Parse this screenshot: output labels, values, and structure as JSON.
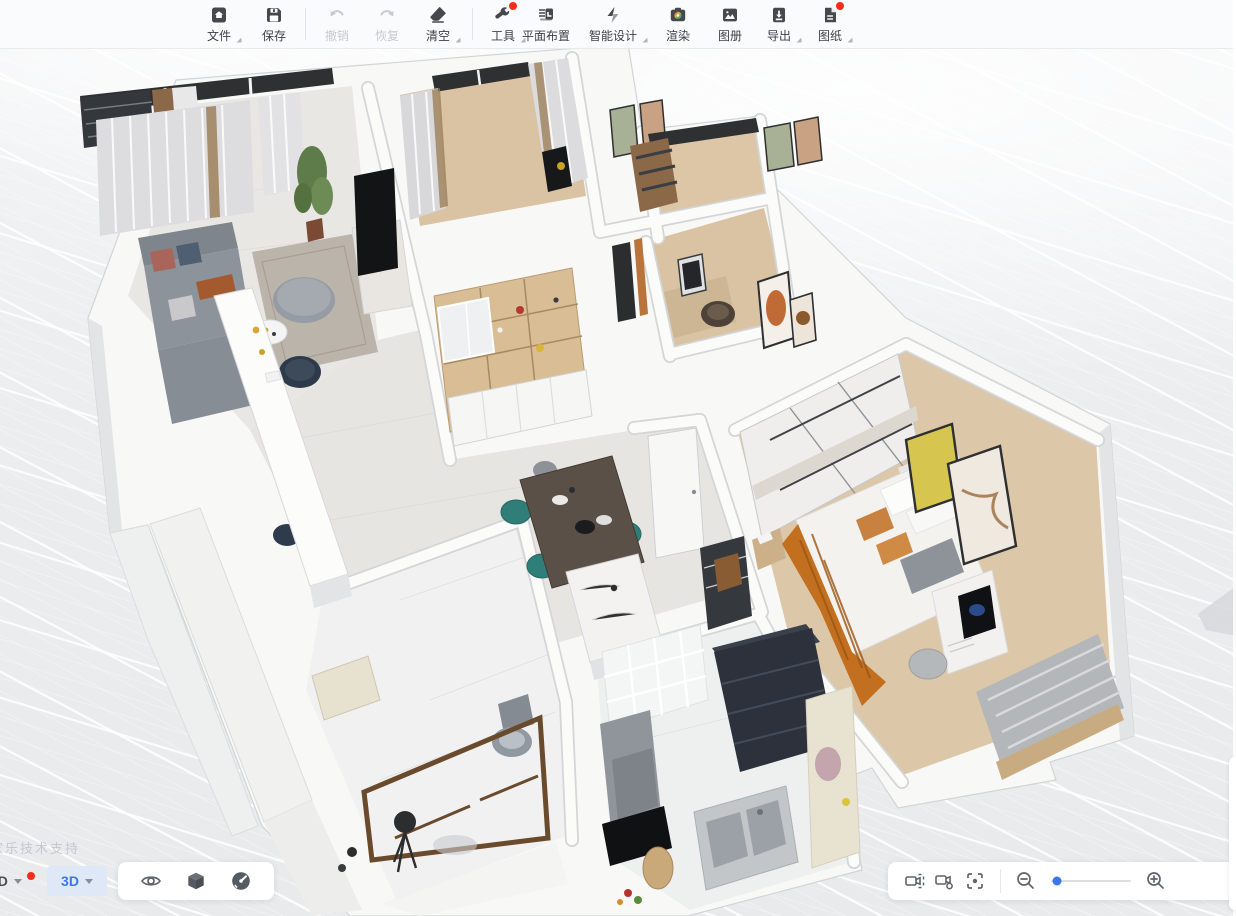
{
  "toolbar": {
    "items": [
      {
        "label": "文件",
        "icon": "file-icon",
        "caret": true,
        "disabled": false,
        "badge": false
      },
      {
        "label": "保存",
        "icon": "save-icon",
        "caret": false,
        "disabled": false,
        "badge": false
      },
      {
        "label": "撤销",
        "icon": "undo-icon",
        "caret": false,
        "disabled": true,
        "badge": false
      },
      {
        "label": "恢复",
        "icon": "redo-icon",
        "caret": false,
        "disabled": true,
        "badge": false
      },
      {
        "label": "清空",
        "icon": "eraser-icon",
        "caret": true,
        "disabled": false,
        "badge": false
      },
      {
        "label": "工具",
        "icon": "wrench-icon",
        "caret": true,
        "disabled": false,
        "badge": true
      },
      {
        "label": "平面布置",
        "icon": "floorplan-layout-icon",
        "caret": false,
        "disabled": false,
        "badge": false
      },
      {
        "label": "智能设计",
        "icon": "smart-design-icon",
        "caret": true,
        "disabled": false,
        "badge": false
      },
      {
        "label": "渲染",
        "icon": "render-camera-icon",
        "caret": false,
        "disabled": false,
        "badge": false
      },
      {
        "label": "图册",
        "icon": "album-icon",
        "caret": false,
        "disabled": false,
        "badge": false
      },
      {
        "label": "导出",
        "icon": "export-icon",
        "caret": true,
        "disabled": false,
        "badge": false
      },
      {
        "label": "图纸",
        "icon": "drawings-icon",
        "caret": true,
        "disabled": false,
        "badge": true
      }
    ]
  },
  "view_mode": {
    "label_2d": "2D",
    "label_3d": "3D",
    "active": "3D",
    "badge_on_2d": true
  },
  "viewport_tools_left": [
    "visibility-eye",
    "solid-cube",
    "performance-gauge"
  ],
  "viewport_tools_right": [
    "camera-view",
    "camera-settings",
    "focus-center"
  ],
  "zoom": {
    "level_percent": 7
  },
  "watermark": "家乐技术支持",
  "colors": {
    "accent_blue": "#3b77e8",
    "badge_red": "#fa2c19",
    "canvas_bg": "#eceef0",
    "grid_line": "#ffffff",
    "wall_white": "#fafafa",
    "wood_floor": "#dcc6a6",
    "marble_floor": "#e9e7e3",
    "teal_chair": "#2f7e79",
    "orange_blanket": "#c2701f",
    "navy_cabinet": "#2c313b",
    "tan_cabinet": "#d8bd95"
  },
  "scene": {
    "type": "3d-floorplan-perspective",
    "view": "bird's-eye dollhouse, rotated ~20°, white walls, perspective grid ground",
    "rooms": [
      {
        "name": "living-room",
        "floor": "light marble",
        "furniture": [
          "gray L-sofa",
          "round gray ottoman",
          "rug",
          "dark armchair",
          "white island counter",
          "marble TV console",
          "black TV",
          "plant",
          "gray curtains",
          "black framed windows"
        ]
      },
      {
        "name": "second-bedroom-balcony",
        "floor": "wood",
        "furniture": [
          "gray curtains with wood trim",
          "black window frame",
          "black floor object"
        ]
      },
      {
        "name": "study",
        "floor": "wood",
        "furniture": [
          "desk",
          "monitor",
          "rattan chair",
          "orange wall art"
        ]
      },
      {
        "name": "master-bedroom",
        "floor": "wood",
        "furniture": [
          "white sliding wardrobe",
          "double bed white duvet",
          "orange throw blanket",
          "orange pillows",
          "yellow wall art",
          "marble wall art",
          "computer desk",
          "gray chair",
          "gray louver panel",
          "nightstand"
        ]
      },
      {
        "name": "dining-hall",
        "floor": "light marble",
        "furniture": [
          "dark wood dining table",
          "teal chairs",
          "marble island",
          "tan shelving cabinet with white base cabinets",
          "entry door",
          "dark shoe shelf with brown bag"
        ]
      },
      {
        "name": "bathroom",
        "floor": "white marble tile",
        "furniture": [
          "toilet",
          "brown framed shower glass",
          "cream vanity",
          "black tripod lamp"
        ]
      },
      {
        "name": "kitchen",
        "floor": "white tile",
        "furniture": [
          "white grid glass door",
          "dark navy cabinet",
          "cream counter",
          "double sink",
          "gray range hood",
          "black cooktop",
          "cutting board",
          "vegetables"
        ]
      }
    ]
  }
}
